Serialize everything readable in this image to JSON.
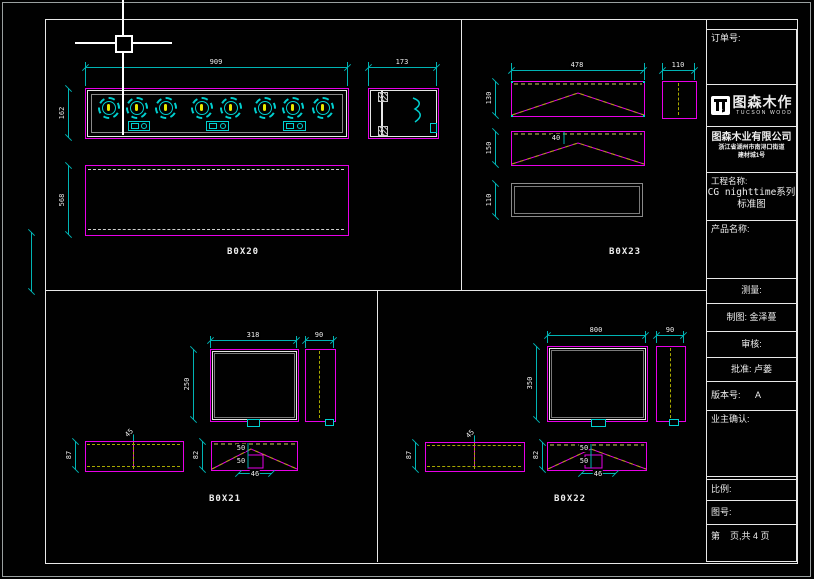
{
  "title_block": {
    "order_label": "订单号:",
    "brand_name": "图森木作",
    "brand_sub": "TUCSON WOOD",
    "company_name": "图森木业有限公司",
    "company_address_1": "浙江省湖州市南浔口街道",
    "company_address_2": "建材城1号",
    "project_label": "工程名称:",
    "project_value_1": "CG nighttime系列",
    "project_value_2": "标准图",
    "product_label": "产品名称:",
    "measure_label": "测量:",
    "draft_label": "制图: 金泽蔓",
    "audit_label": "审核:",
    "approve_label": "批准: 卢蒌",
    "version_label": "版本号:",
    "version_value": "A",
    "owner_label": "业主确认:",
    "scale_label": "比例:",
    "sheet_no_label": "图号:",
    "page_label": "第    页,共 4 页"
  },
  "drawing": {
    "box20": {
      "label": "B0X20",
      "width": "909",
      "height": "162",
      "side_width": "173",
      "depth": "568"
    },
    "box23": {
      "label": "B0X23",
      "width": "478",
      "side_width": "110",
      "h_top": "130",
      "h_mid": "150",
      "h_bottom": "110",
      "apex_offset": "40"
    },
    "box21": {
      "label": "B0X21",
      "width": "318",
      "height": "250",
      "side_width": "90",
      "strip_height": "87",
      "strip_rot": "45",
      "tri_height": "82",
      "d_upper": "50",
      "d_lower": "50",
      "base": "46"
    },
    "box22": {
      "label": "B0X22",
      "width": "800",
      "height": "350",
      "side_width": "90",
      "strip_height": "87",
      "strip_rot": "45",
      "tri_height": "82",
      "d_upper": "50",
      "d_lower": "50",
      "base": "46"
    }
  },
  "colors": {
    "background": "#000000",
    "geometry": "#e800e8",
    "dimension": "#00b4b4",
    "hatch_dash": "#a8a800",
    "knob": "#00d0d0",
    "knob_center": "#e8e800",
    "text": "#ededed"
  }
}
